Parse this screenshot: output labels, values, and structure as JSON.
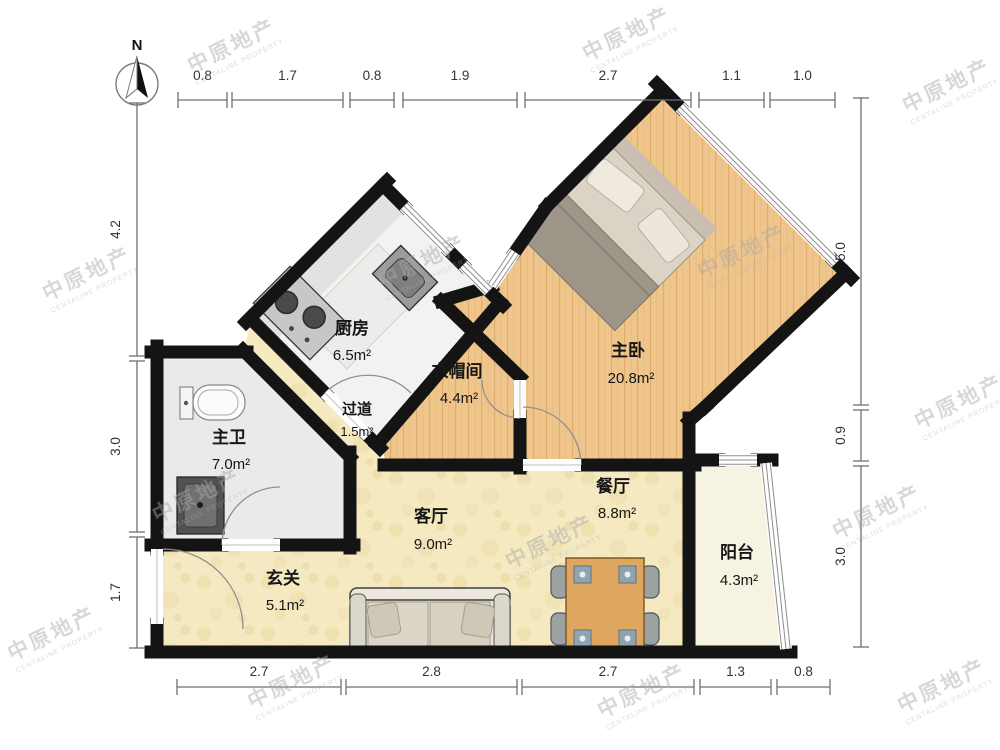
{
  "compass": {
    "label": "N"
  },
  "watermark": {
    "line1": "中原地产",
    "line2": "CENTALINE PROPERTY"
  },
  "rooms": [
    {
      "id": "kitchen",
      "name": "厨房",
      "area": "6.5m²"
    },
    {
      "id": "master-bedroom",
      "name": "主卧",
      "area": "20.8m²"
    },
    {
      "id": "cloakroom",
      "name": "衣帽间",
      "area": "4.4m²"
    },
    {
      "id": "corridor",
      "name": "过道",
      "area": "1.5m²"
    },
    {
      "id": "master-bath",
      "name": "主卫",
      "area": "7.0m²"
    },
    {
      "id": "living-room",
      "name": "客厅",
      "area": "9.0m²"
    },
    {
      "id": "dining-room",
      "name": "餐厅",
      "area": "8.8m²"
    },
    {
      "id": "entry-hall",
      "name": "玄关",
      "area": "5.1m²"
    },
    {
      "id": "balcony",
      "name": "阳台",
      "area": "4.3m²"
    }
  ],
  "dimensions": {
    "top": [
      "0.8",
      "1.7",
      "0.8",
      "1.9",
      "2.7",
      "1.1",
      "1.0"
    ],
    "bottom": [
      "2.7",
      "2.8",
      "2.7",
      "1.3",
      "0.8"
    ],
    "left": [
      "4.2",
      "3.0",
      "1.7"
    ],
    "right": [
      "5.0",
      "0.9",
      "3.0"
    ]
  },
  "colors": {
    "wall": "#141414",
    "wood_floor": "#efc58c",
    "bath_floor": "#eaeae8",
    "kitchen_floor": "#f2f2f0",
    "living_floor": "#f4e9c0",
    "balcony_floor": "#f7f3e3"
  }
}
